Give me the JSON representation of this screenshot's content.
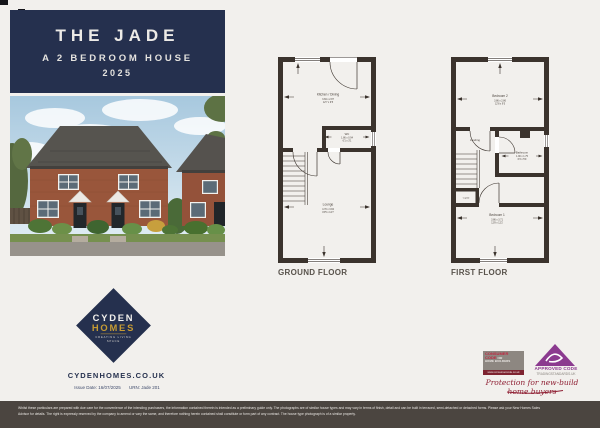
{
  "header": {
    "title": "THE JADE",
    "subtitle": "A 2 BEDROOM HOUSE",
    "year": "2025"
  },
  "brand": {
    "logo_top": "CYDEN",
    "logo_bottom": "HOMES",
    "tagline_line1": "CREATING LIVING",
    "tagline_line2": "SPACE",
    "website": "CYDENHOMES.CO.UK",
    "issue_date": "Issue Date: 16/07/2025",
    "urn": "URN: Jade 201"
  },
  "colors": {
    "navy": "#25304e",
    "gold": "#c69b33",
    "wall": "#3b332d",
    "bar": "#4b4540",
    "accent_red": "#8f1f33",
    "purple": "#8b3a8f"
  },
  "plans": {
    "ground": {
      "label": "GROUND FLOOR",
      "kitchen": {
        "name": "Kitchen / Dining",
        "metric": "3.84 x 2.87",
        "imperial": "12'7 x 9'5"
      },
      "wc": {
        "name": "WC",
        "metric": "1.86 x 0.94",
        "imperial": "6'1 x 3'1"
      },
      "lounge": {
        "name": "Lounge",
        "metric": "4.70 x 3.84",
        "imperial": "15'5 x 12'7"
      }
    },
    "first": {
      "label": "FIRST FLOOR",
      "bedroom2": {
        "name": "Bedroom 2",
        "metric": "3.86 x 2.86",
        "imperial": "12'8 x 9'5"
      },
      "landing": {
        "name": "Landing"
      },
      "bathroom": {
        "name": "Bathroom",
        "metric": "1.90 x 1.75",
        "imperial": "6'3 x 5'9"
      },
      "cupboard": {
        "name": "Cupbd"
      },
      "bedroom1": {
        "name": "Bedroom 1",
        "metric": "3.86 x 3.71",
        "imperial": "12'8 x 12'2"
      }
    }
  },
  "badges": {
    "consumer_code": {
      "word1": "CONSUMER",
      "word2": "CODE",
      "word_for": "FOR",
      "word3": "HOME BUILDERS",
      "url": "www.consumercode.co.uk"
    },
    "approved_code": {
      "label": "APPROVED CODE",
      "sub": "TRADINGSTANDARDS.UK"
    },
    "strapline": "Protection for new-build home buyers"
  },
  "footer": {
    "disclaimer": "Whilst these particulars are prepared with due care for the convenience of the intending purchasers, the information contained therein is intended as a preliminary guide only. The photographs are of similar house types and may vary in terms of finish, detail and can be built in terraced, semi-detached or detached forms. Please ask your New Homes Sales Advisor for details. The right is expressly reserved by the company to amend or vary the same, and therefore nothing herein contained shall constitute or form part of any contract. The house type photograph is of a similar property."
  }
}
